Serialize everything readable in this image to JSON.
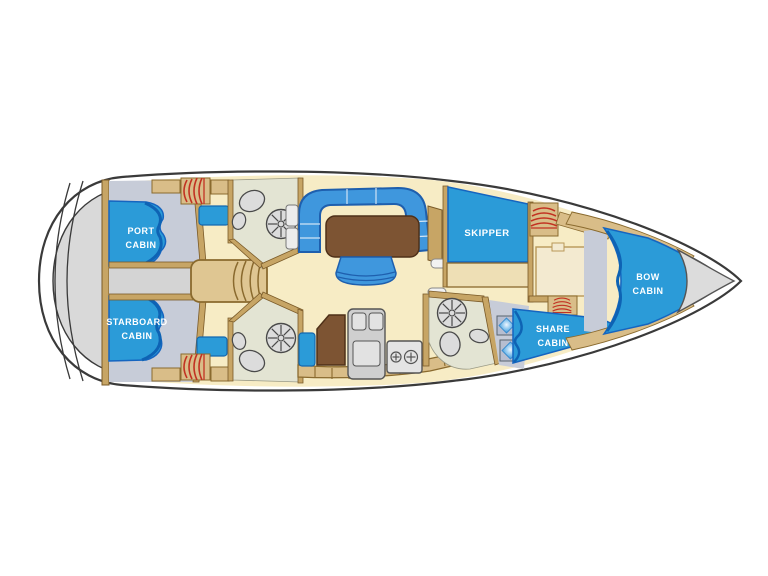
{
  "cabins": {
    "port_cabin": [
      "PORT",
      "CABIN"
    ],
    "starboard_cabin": [
      "STARBOARD",
      "CABIN"
    ],
    "skipper": [
      "SKIPPER"
    ],
    "bow_cabin": [
      "BOW",
      "CABIN"
    ],
    "share_cabin": [
      "SHARE",
      "CABIN"
    ]
  },
  "colors": {
    "hull_line": "#3a3a3a",
    "deck_gray": "#d9d9d9",
    "floor_cream": "#f7ecc5",
    "cabin_floor_gray": "#c7ccd8",
    "bed_blue": "#2b9bd8",
    "bed_blue_dark": "#0e63b4",
    "settee_blue": "#3f97dd",
    "table_brown": "#7d5433",
    "wood_tan": "#d9bd88",
    "wood_outline": "#8a6a2e",
    "bath_floor": "#e3e4d3",
    "fixture_gray": "#dcdcdc",
    "radiator_red": "#c23222",
    "label_text": "#ffffff"
  },
  "icons": {
    "shower": "spoked-circle",
    "toilet": "oval-bowl",
    "sink": "small-oval-basin",
    "stove": "two-burner-hob",
    "galley_sink": "double-basin",
    "radiator": "red-coil",
    "deck_hatch": "blue-diamond-skylight",
    "companionway": "curved-steps",
    "salon": "u-settee-table-stool",
    "anchor_locker": "bow-triangle"
  }
}
